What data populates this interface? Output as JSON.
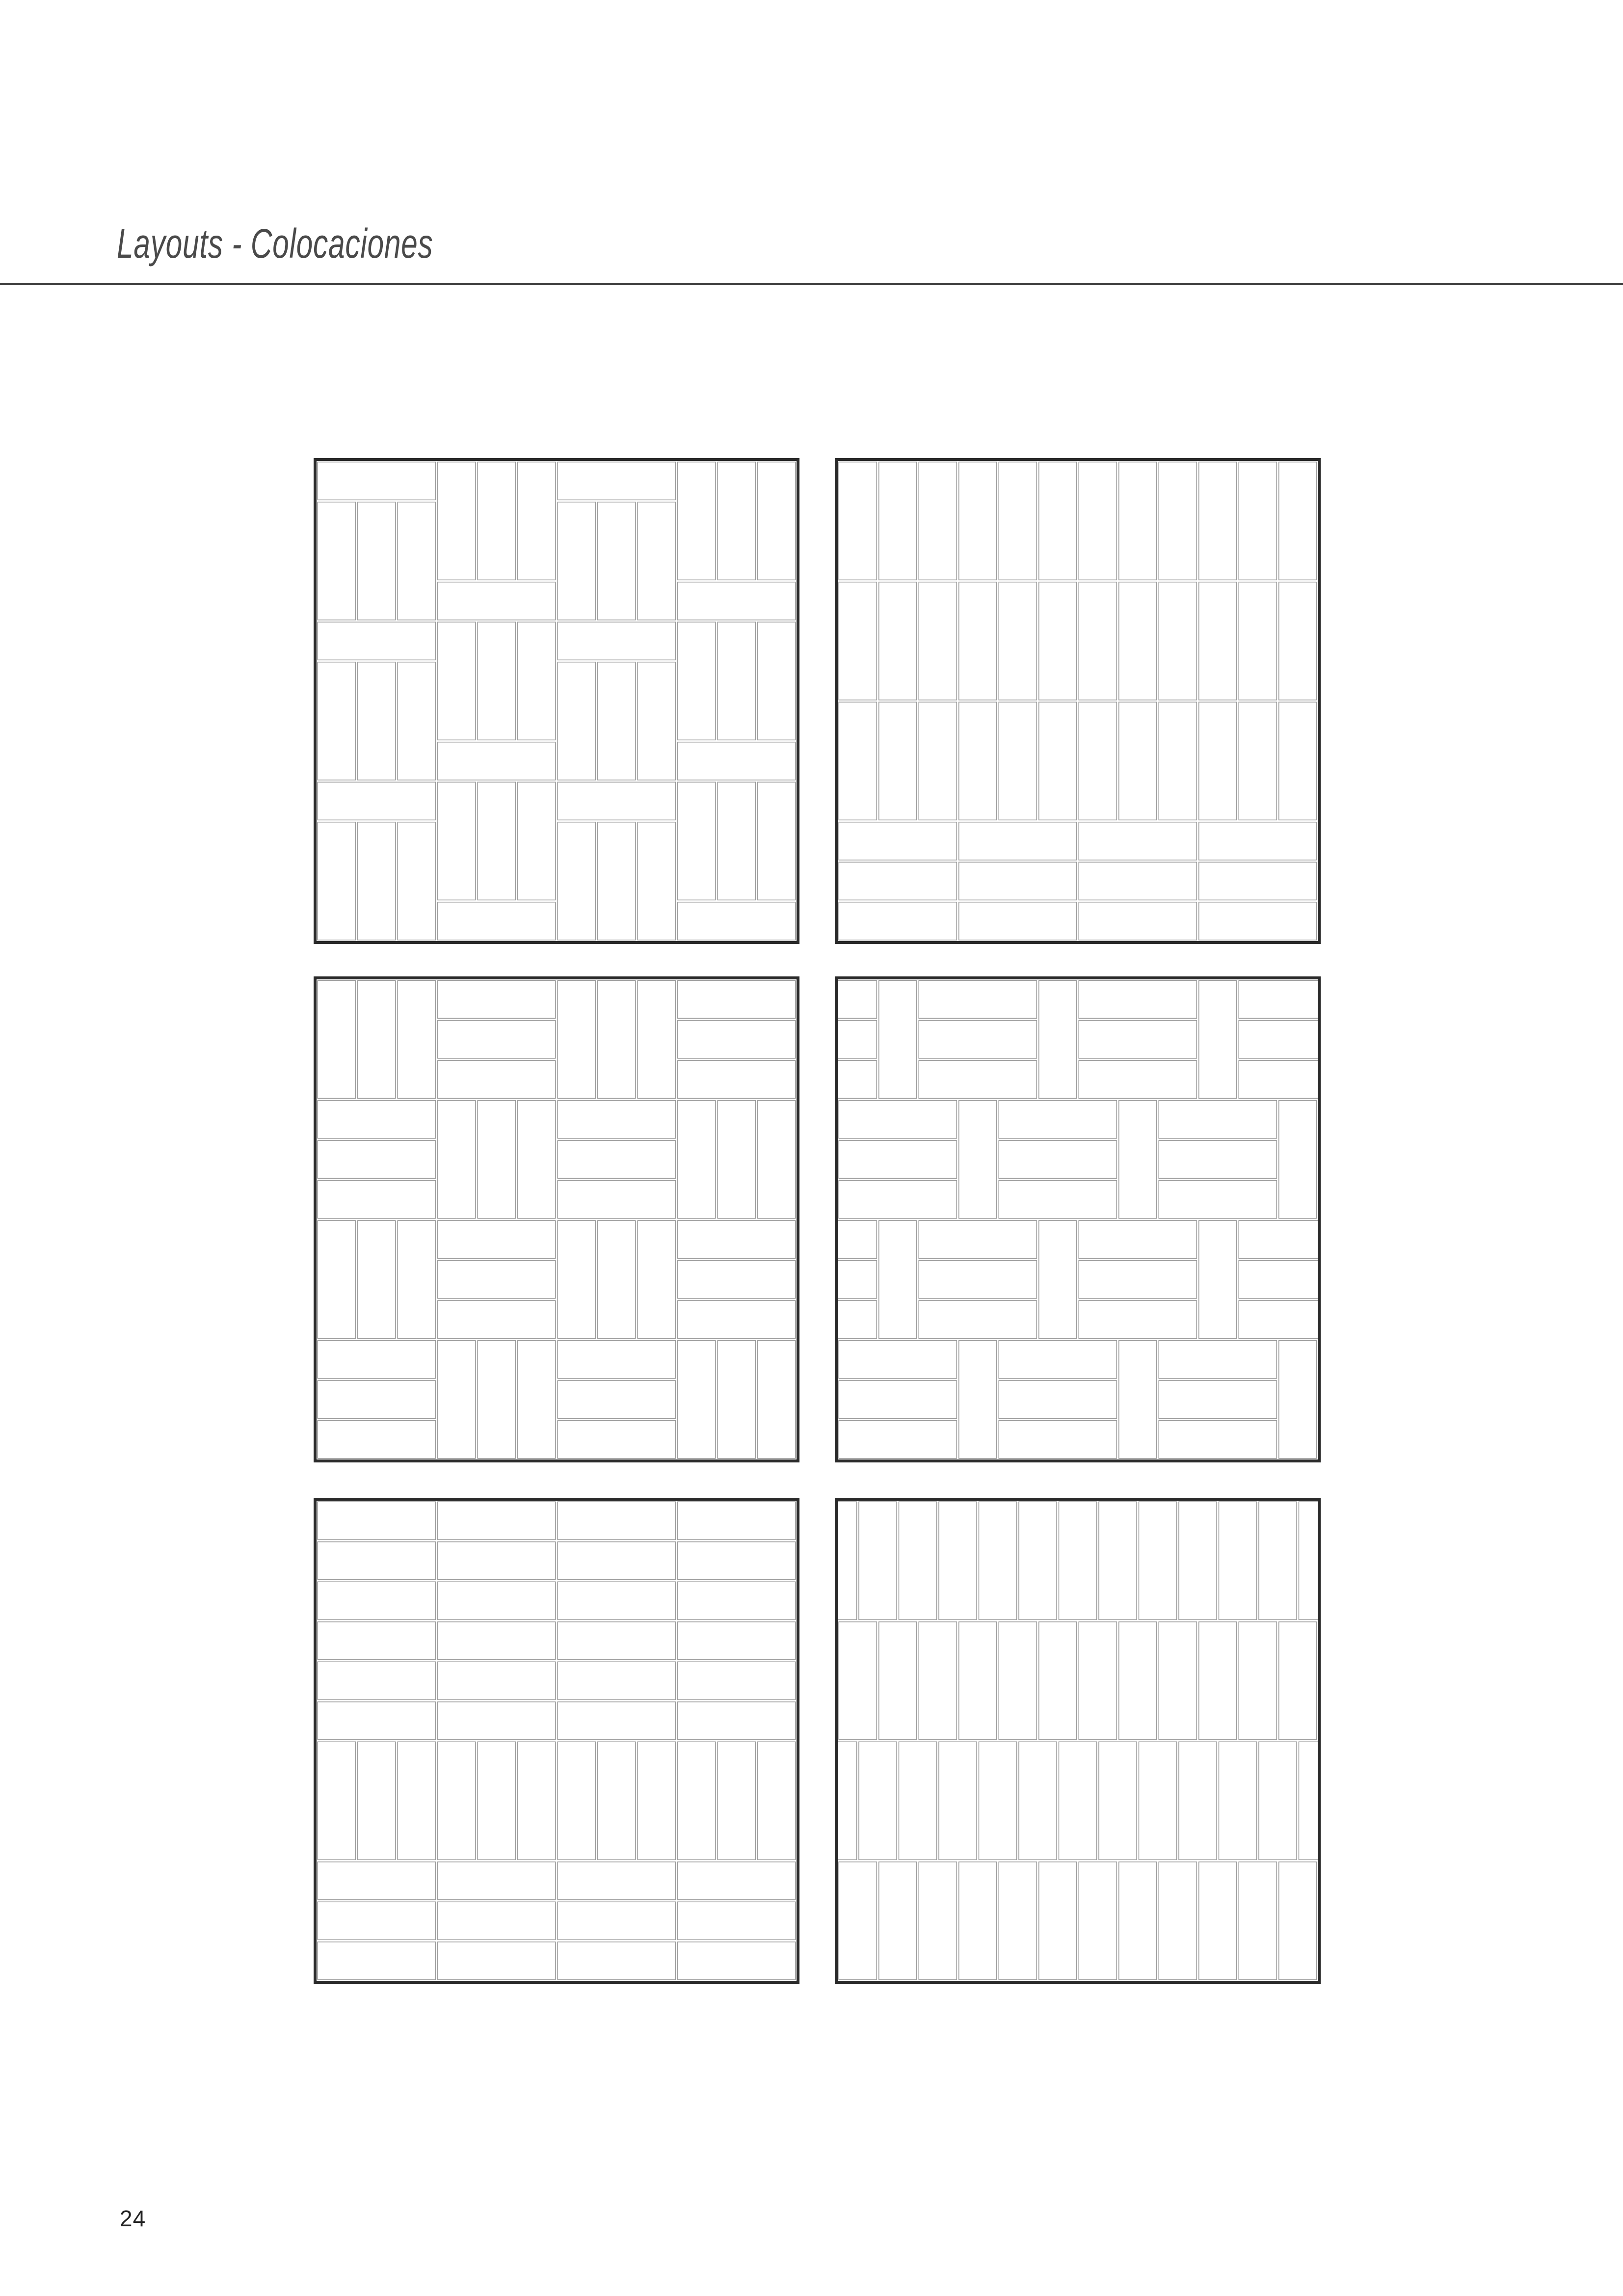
{
  "page": {
    "title": "Layouts - Colocaciones",
    "page_number": "24"
  },
  "style": {
    "background_color": "#ffffff",
    "title_color": "#4a4a4a",
    "rule_color": "#3c3c3c",
    "page_number_color": "#222222",
    "box_border_color": "#2a2a2a",
    "tile_stroke_color": "#9b9b9b",
    "tile_fill_color": "#ffffff"
  },
  "tile_spec": {
    "ratio": "1:3",
    "orientations": [
      "vertical",
      "horizontal"
    ]
  },
  "patterns": [
    {
      "id": "pattern-1",
      "position": "top-left",
      "type": "column-units",
      "name": "stacked triple-vertical with horizontal header, alternating column phase",
      "columns": 4,
      "units_per_column": 3,
      "unit": "1 horizontal tile + 3 vertical tiles",
      "alternate_phase": true
    },
    {
      "id": "pattern-2",
      "position": "top-right",
      "type": "stack-bond-mixed",
      "name": "vertical stack bond over horizontal stack rows",
      "vertical_rows": 3,
      "vertical_columns": 12,
      "horizontal_rows": 3,
      "horizontal_columns": 4
    },
    {
      "id": "pattern-3",
      "position": "middle-left",
      "type": "basketweave",
      "name": "triple basketweave checkerboard",
      "block_rows": 4,
      "block_cols": 4,
      "tiles_per_block": 3,
      "first_block": "vertical"
    },
    {
      "id": "pattern-4",
      "position": "middle-right",
      "type": "band-weave",
      "name": "vertical tile + triple horizontal block bands, half-unit offset",
      "bands": 4,
      "half_offset": true,
      "tiles_per_horizontal_block": 3
    },
    {
      "id": "pattern-5",
      "position": "bottom-left",
      "type": "rows-and-band",
      "name": "horizontal stack rows with central vertical band",
      "top_horizontal_rows": 6,
      "vertical_band_columns": 12,
      "bottom_horizontal_rows": 3,
      "horizontal_columns": 4
    },
    {
      "id": "pattern-6",
      "position": "bottom-right",
      "type": "vertical-running-bond",
      "name": "vertical running bond, half-tile offset bands",
      "bands": 4,
      "columns": 12,
      "offset_fraction": 0.5
    }
  ]
}
